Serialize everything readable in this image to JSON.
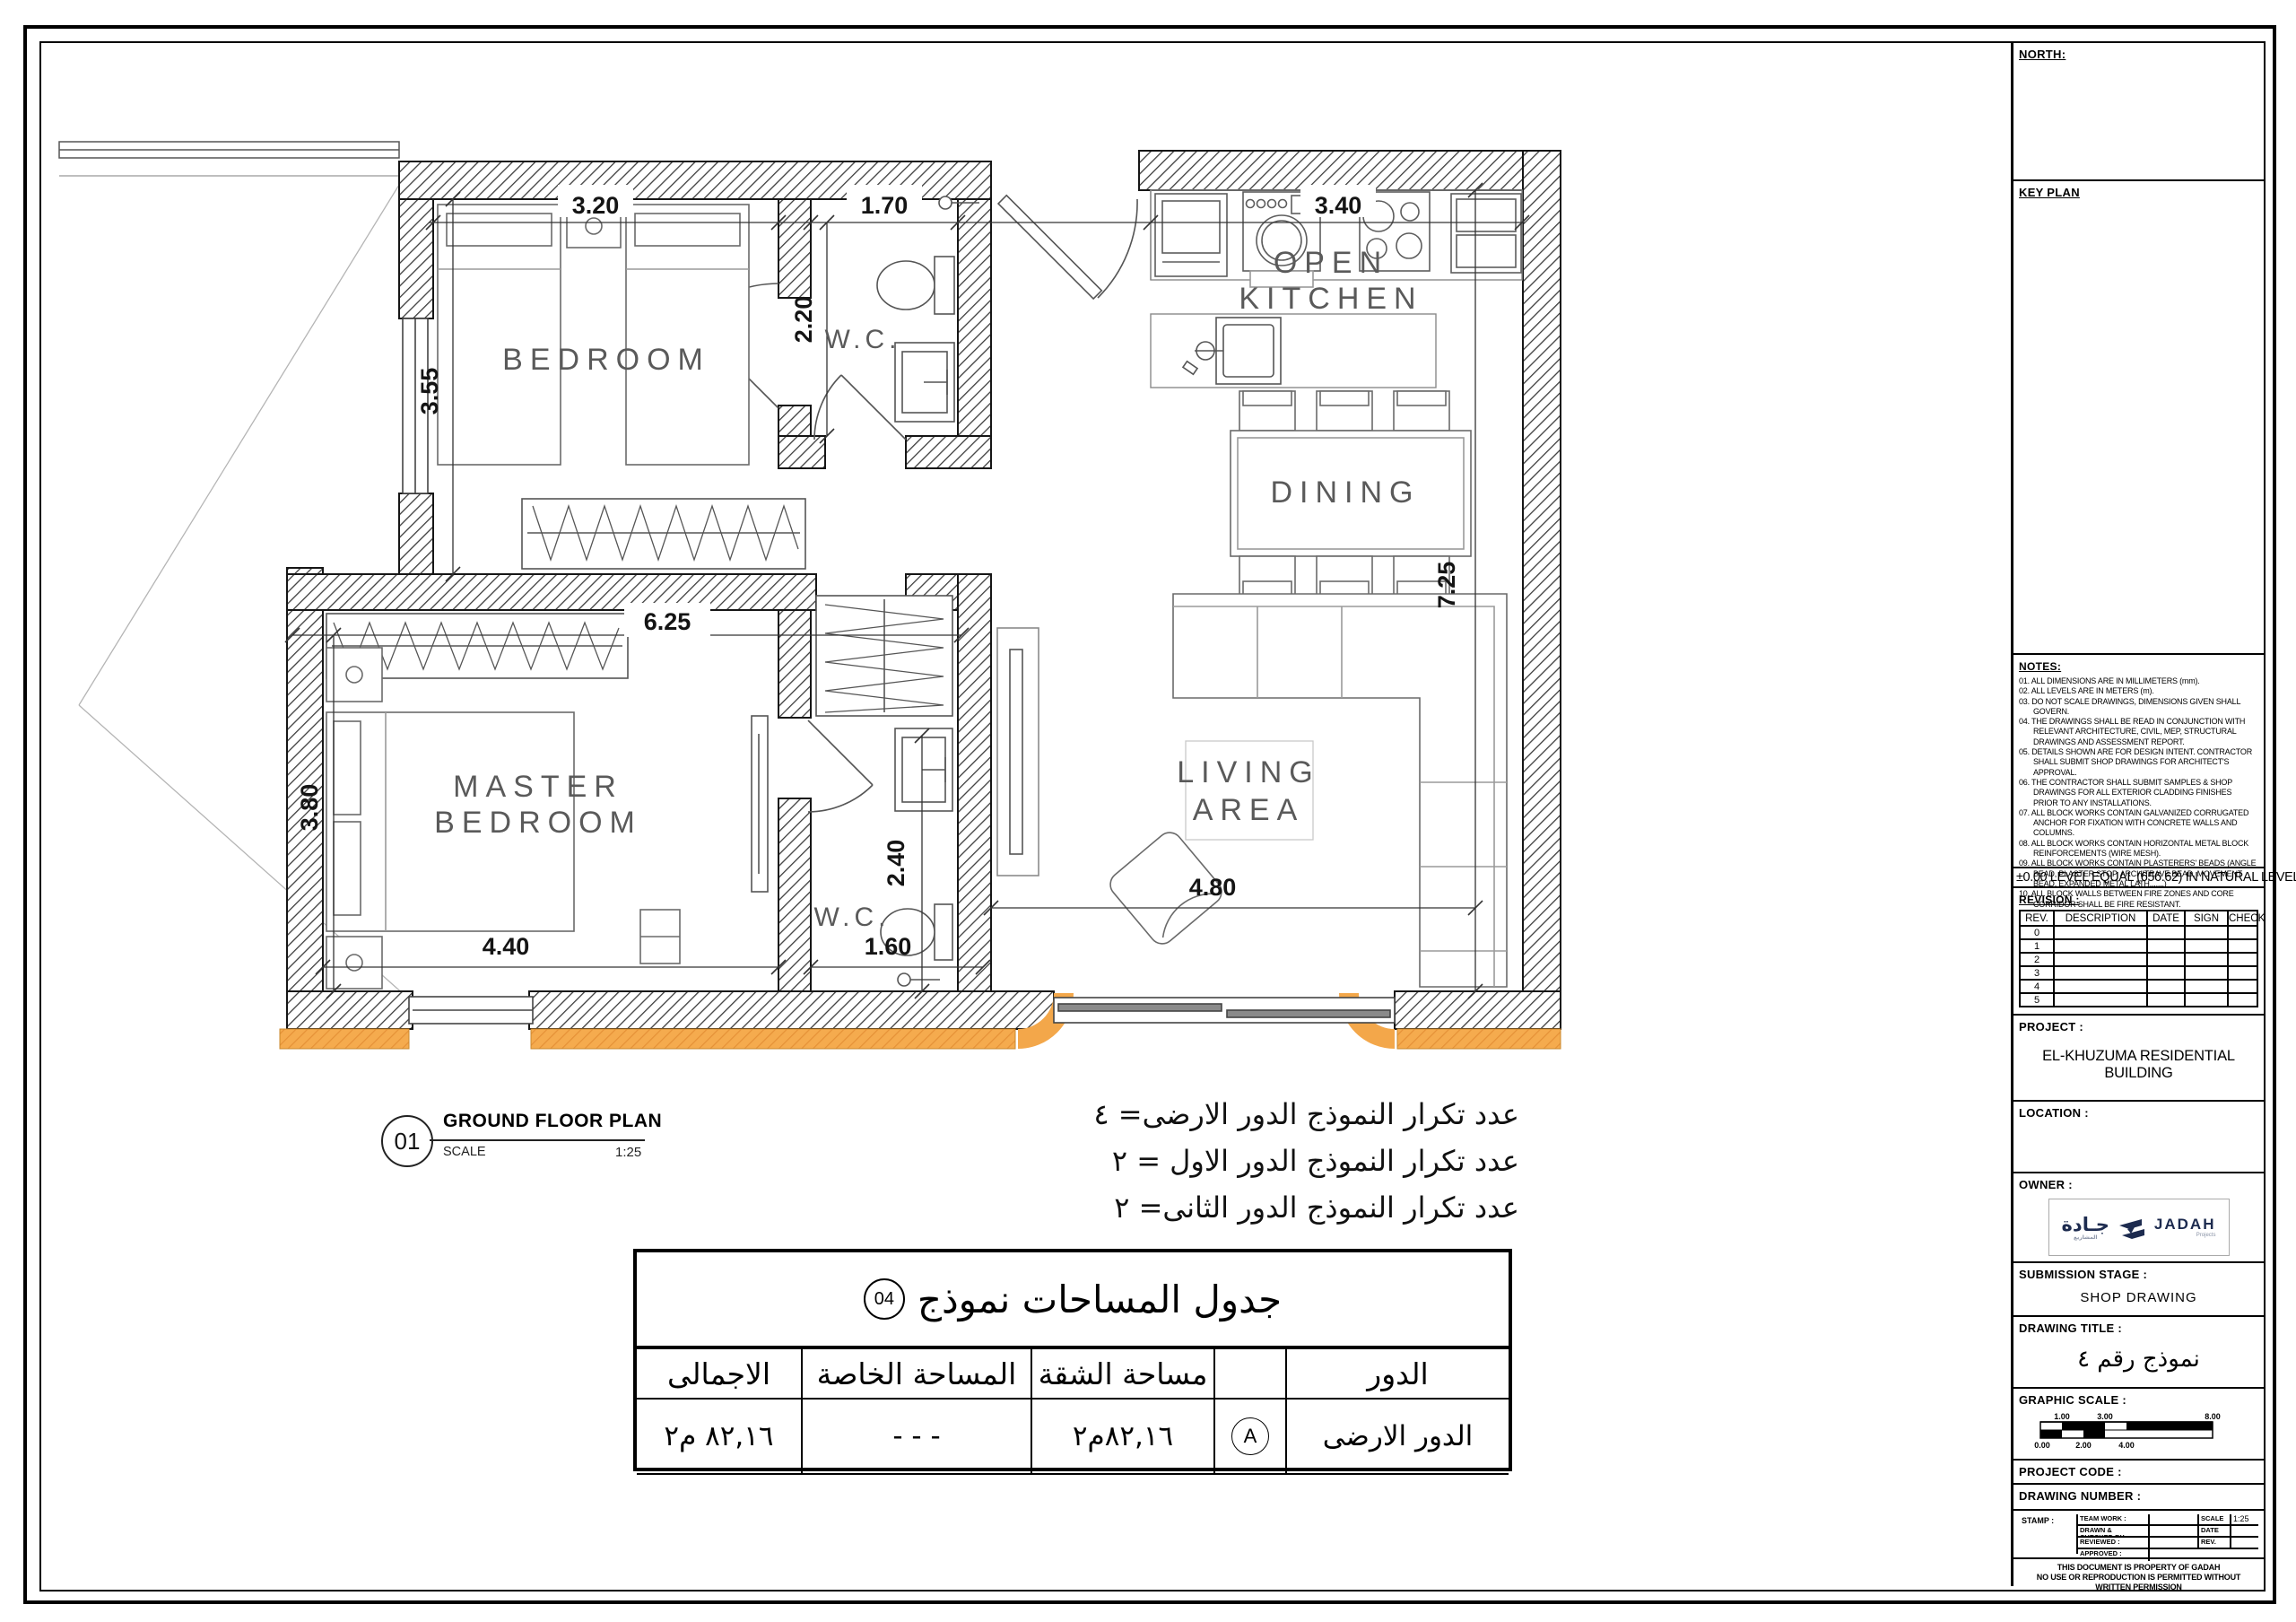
{
  "plan": {
    "rooms": {
      "bedroom": "BEDROOM",
      "wc_top": "W.C.",
      "kitchen_line1": "OPEN",
      "kitchen_line2": "KITCHEN",
      "dining": "DINING",
      "master_line1": "MASTER",
      "master_line2": "BEDROOM",
      "wc_bottom": "W.C.",
      "living_line1": "LIVING",
      "living_line2": "AREA"
    },
    "dims": {
      "bedroom_w": "3.20",
      "wc_top_w": "1.70",
      "kitchen_w": "3.40",
      "bedroom_h": "3.55",
      "wc_top_h": "2.20",
      "block_w": "6.25",
      "master_h": "3.80",
      "master_w": "4.40",
      "wc_bottom_w": "1.60",
      "wc_bottom_h": "2.40",
      "right_h": "7.25",
      "living_w": "4.80"
    }
  },
  "callout": {
    "number": "01",
    "title": "GROUND FLOOR PLAN",
    "scale_label": "SCALE",
    "scale_value": "1:25"
  },
  "repeat_notes": [
    "عدد تكرار النموذج الدور الارضى= ٤",
    "عدد تكرار النموذج الدور الاول = ٢",
    "عدد تكرار النموذج الدور الثانى= ٢"
  ],
  "area_table": {
    "title": "جدول المساحات نموذج",
    "badge": "04",
    "headers": {
      "floor": "الدور",
      "apartment": "مساحة الشقة",
      "private": "المساحة الخاصة",
      "total": "الاجمالى"
    },
    "row": {
      "floor": "الدور الارضى",
      "tag": "A",
      "apartment": "٨٢,١٦م٢",
      "private": "- - -",
      "total": "٨٢,١٦ م٢"
    }
  },
  "titleblock": {
    "north_label": "NORTH:",
    "keyplan_label": "KEY PLAN",
    "notes_label": "NOTES:",
    "notes": [
      "01. ALL DIMENSIONS ARE IN MILLIMETERS (mm).",
      "02. ALL LEVELS ARE IN METERS (m).",
      "03. DO NOT SCALE DRAWINGS, DIMENSIONS GIVEN SHALL GOVERN.",
      "04. THE DRAWINGS SHALL BE READ IN CONJUNCTION WITH RELEVANT ARCHITECTURE, CIVIL, MEP, STRUCTURAL DRAWINGS AND ASSESSMENT REPORT.",
      "05. DETAILS SHOWN ARE FOR DESIGN INTENT. CONTRACTOR SHALL SUBMIT SHOP DRAWINGS FOR ARCHITECT'S APPROVAL.",
      "06. THE CONTRACTOR SHALL SUBMIT SAMPLES & SHOP DRAWINGS FOR ALL EXTERIOR CLADDING FINISHES PRIOR TO ANY INSTALLATIONS.",
      "07. ALL BLOCK WORKS CONTAIN GALVANIZED CORRUGATED ANCHOR FOR FIXATION WITH CONCRETE WALLS AND COLUMNS.",
      "08. ALL BLOCK WORKS CONTAIN HORIZONTAL METAL BLOCK REINFORCEMENTS (WIRE MESH).",
      "09. ALL BLOCK WORKS CONTAIN PLASTERERS' BEADS (ANGLE BEAD, PLASTER STOP, ARCHITRAVE BEAD, MOVEMENT BEAD, EXPANDED METAL LATH,......)",
      "10. ALL BLOCK WALLS BETWEEN FIRE ZONES AND CORE CORRIDOR SHALL BE FIRE RESISTANT."
    ],
    "level_note": "±0.00 LEVEL EQUAL (656.62) IN NATURAL LEVEL",
    "revision_label": "REVISION :",
    "revision_headers": [
      "REV.",
      "DESCRIPTION",
      "DATE",
      "SIGN",
      "CHECK"
    ],
    "revision_rows": [
      "0",
      "1",
      "2",
      "3",
      "4",
      "5"
    ],
    "project_label": "PROJECT :",
    "project_value": "EL-KHUZUMA RESIDENTIAL BUILDING",
    "location_label": "LOCATION :",
    "owner_label": "OWNER :",
    "logo": {
      "arabic": "جـادة",
      "arabic_sub": "المشاريع",
      "latin": "JADAH",
      "latin_sub": "Projects"
    },
    "submission_label": "SUBMISSION STAGE :",
    "submission_value": "SHOP DRAWING",
    "drawing_title_label": "DRAWING TITLE :",
    "drawing_title_value": "نموذج رقم ٤",
    "graphic_scale_label": "GRAPHIC SCALE :",
    "scale_top_ticks": [
      "1.00",
      "3.00",
      "8.00"
    ],
    "scale_bottom_ticks": [
      "0.00",
      "2.00",
      "4.00"
    ],
    "project_code_label": "PROJECT CODE :",
    "drawing_number_label": "DRAWING NUMBER :",
    "stamp_label": "STAMP :",
    "stamp": {
      "team": "TEAM WORK :",
      "drawn": "DRAWN & CHECKED BY:",
      "reviewed": "REVIEWED :",
      "approved": "APPROVED :",
      "scale_label": "SCALE",
      "scale_value": "1:25",
      "date_label": "DATE",
      "rev_label": "REV."
    },
    "footer_line1": "THIS DOCUMENT IS PROPERTY OF GADAH",
    "footer_line2": "NO USE OR REPRODUCTION IS PERMITTED WITHOUT WRITTEN PERMISSION"
  }
}
